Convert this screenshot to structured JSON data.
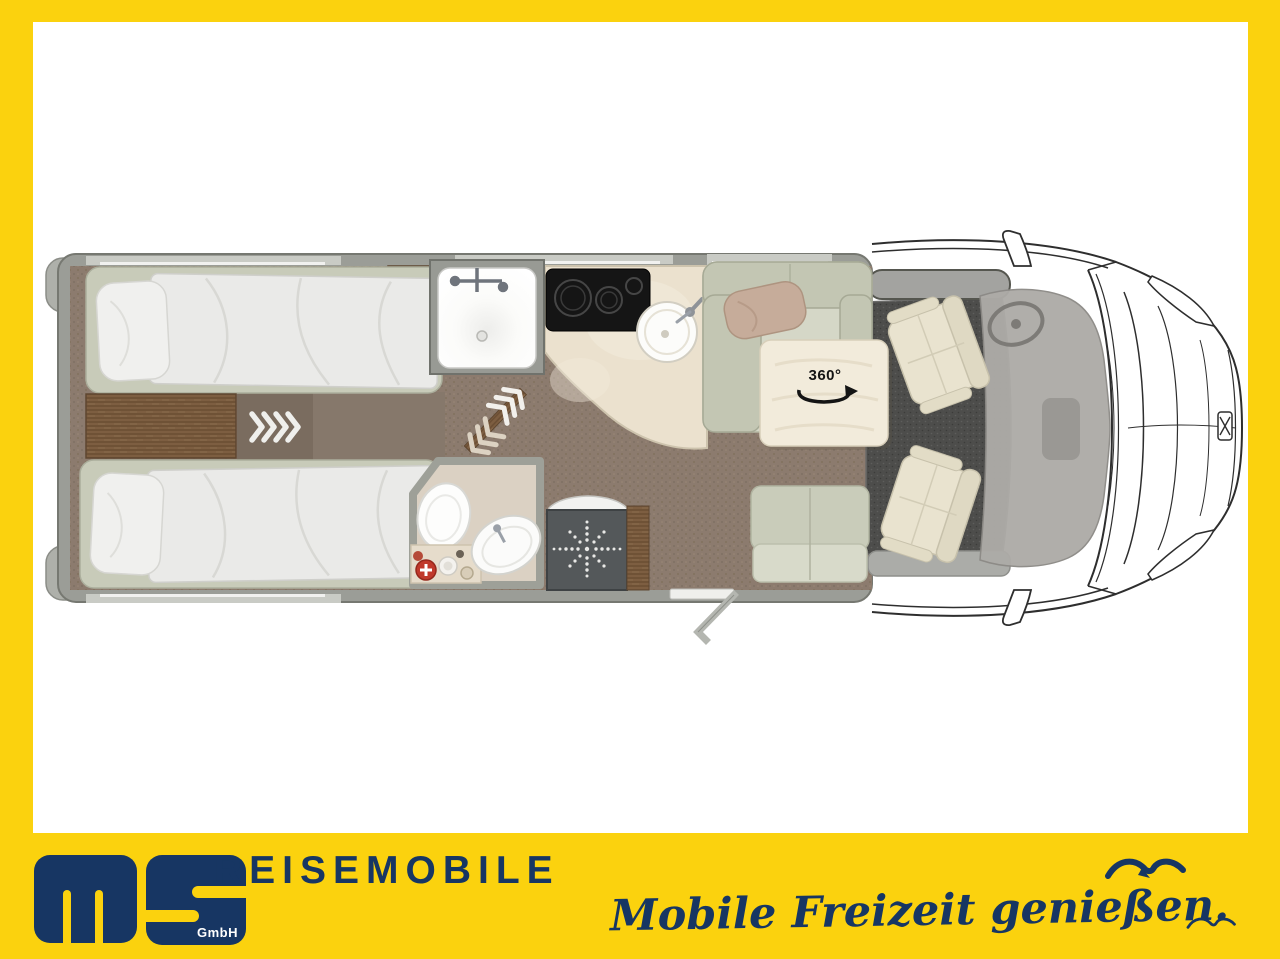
{
  "branding": {
    "brand_word": "REISEMOBILE",
    "company_suffix": "GmbH",
    "tagline": "Mobile Freizeit genießen."
  },
  "floorplan": {
    "table_rotation_label": "360°",
    "features": [
      "rear-twin-bed-top",
      "rear-twin-bed-bottom",
      "bedside-chest",
      "wardrobe",
      "pull-out-chevrons",
      "sliding-door-chevrons",
      "shower-cabin",
      "washroom-toilet",
      "washroom-basin",
      "washroom-counter",
      "shower-tray-drain",
      "kitchen-cooktop",
      "kitchen-sink",
      "l-shaped-sofa",
      "rotating-table",
      "bench-seat",
      "entry-door",
      "driver-swivel-seat",
      "passenger-swivel-seat",
      "cab-dashboard",
      "vehicle-front"
    ]
  },
  "colors": {
    "frame_yellow": "#FBD20E",
    "brand_navy": "#173663",
    "wall_gray": "#9B9D97",
    "carpet_brown": "#8C7B6E",
    "kitchen_cream": "#EBE1CE",
    "cab_carpet": "#4D4D4B",
    "seat_cream": "#E9E3CF",
    "sofa_sage": "#C3C6B3"
  }
}
